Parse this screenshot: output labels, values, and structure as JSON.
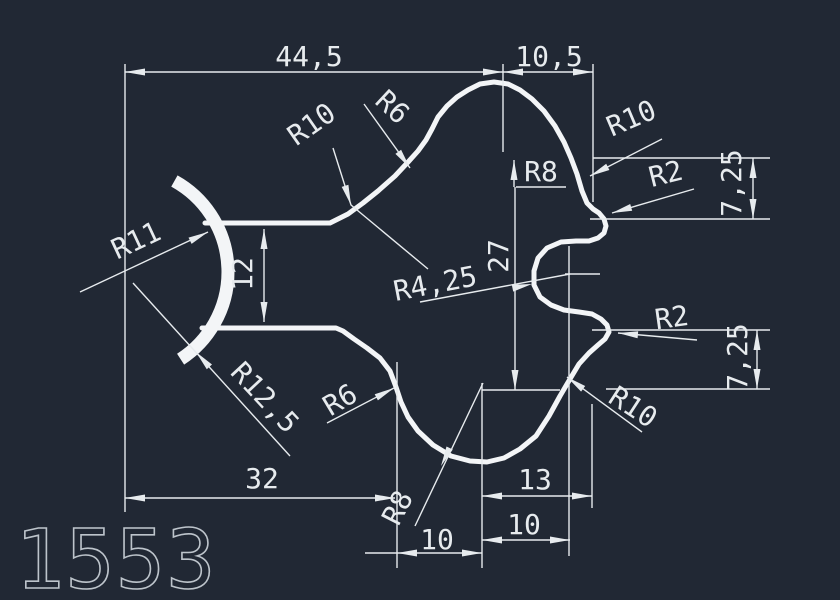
{
  "drawing": {
    "part_number": "1553",
    "background_color": "#212834",
    "line_color": "#e7ebee",
    "profile_color": "#f3f5f7",
    "labels": {
      "dim_total_width": "44,5",
      "dim_top_right_width": "10,5",
      "dim_bottom_width": "32",
      "dim_slot_height": "12",
      "dim_body_height": "27",
      "dim_upper_right_height": "7,25",
      "dim_lower_right_height": "7,25",
      "dim_bottom_13": "13",
      "dim_bottom_10_inner": "10",
      "dim_bottom_10_outer": "10",
      "rad_r11": "R11",
      "rad_r12_5": "R12,5",
      "rad_r10_top_left": "R10",
      "rad_r6_top": "R6",
      "rad_r8_top": "R8",
      "rad_r10_upper_right": "R10",
      "rad_r2_upper": "R2",
      "rad_r4_25": "R4,25",
      "rad_r2_lower": "R2",
      "rad_r10_lower": "R10",
      "rad_r6_bottom": "R6",
      "rad_r8_bottom": "R8"
    }
  }
}
